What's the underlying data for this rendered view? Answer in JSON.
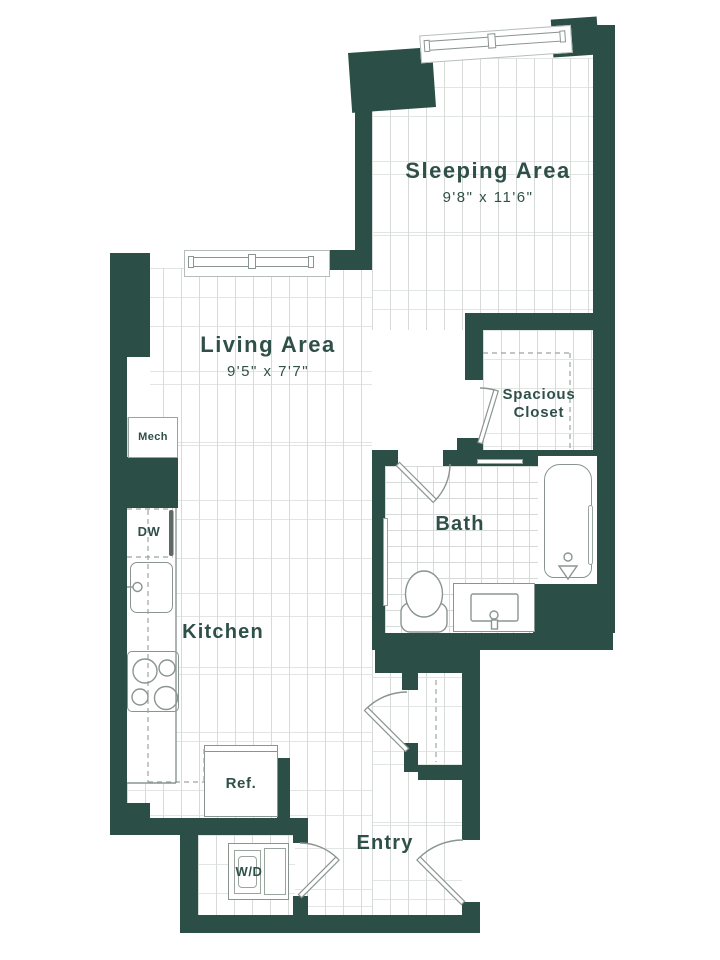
{
  "plan": {
    "rooms": {
      "sleeping": {
        "label": "Sleeping Area",
        "dims": "9'8\" x 11'6\""
      },
      "living": {
        "label": "Living Area",
        "dims": "9'5\" x 7'7\""
      },
      "closet": {
        "label": "Spacious Closet"
      },
      "bath": {
        "label": "Bath"
      },
      "kitchen": {
        "label": "Kitchen"
      },
      "entry": {
        "label": "Entry"
      },
      "mech": {
        "label": "Mech"
      }
    },
    "appliances": {
      "dishwasher": "DW",
      "refrigerator": "Ref.",
      "washer_dryer": "W/D"
    },
    "colors": {
      "wall": "#2b4f46",
      "label_text": "#2f5048",
      "fixture_line": "#8a9590",
      "floor_line": "#d6dbd8"
    }
  }
}
